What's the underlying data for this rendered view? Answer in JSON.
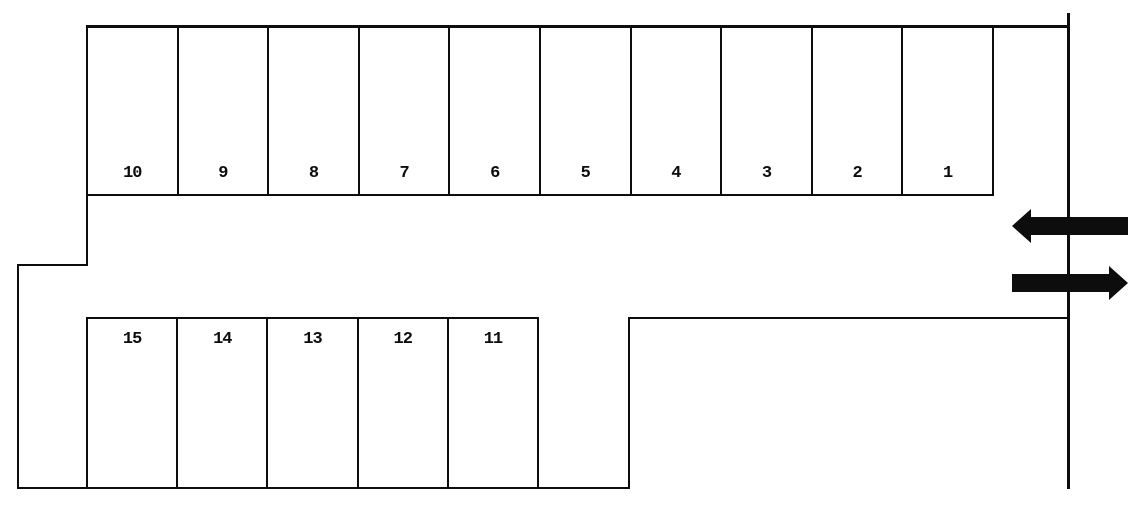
{
  "stalls": {
    "top": [
      "10",
      "9",
      "8",
      "7",
      "6",
      "5",
      "4",
      "3",
      "2",
      "1"
    ],
    "bottom": [
      "15",
      "14",
      "13",
      "12",
      "11"
    ]
  },
  "arrows": {
    "upper_direction": "left",
    "lower_direction": "right"
  },
  "colors": {
    "line": "#0d0d0d",
    "arrow": "#0d0d0d",
    "background": "#ffffff"
  }
}
